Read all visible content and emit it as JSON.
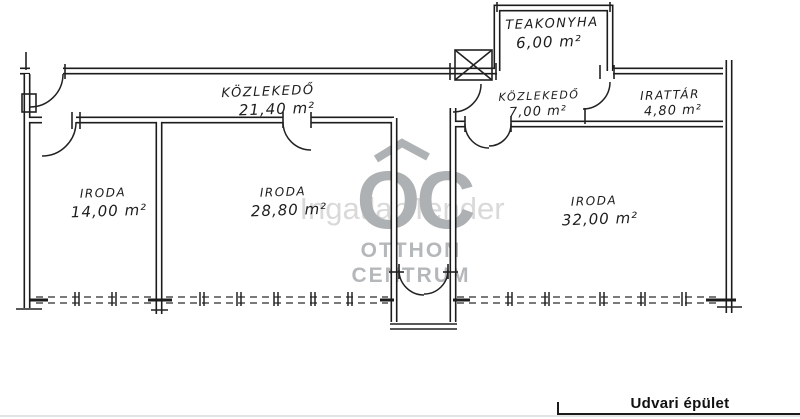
{
  "plan": {
    "caption": "Udvari épület",
    "rooms": [
      {
        "id": "teakonyha",
        "label": "TEAKONYHA",
        "area": "6,00 m²"
      },
      {
        "id": "kozlekedo-main",
        "label": "KÖZLEKEDŐ",
        "area": "21,40 m²"
      },
      {
        "id": "kozlekedo-small",
        "label": "KÖZLEKEDŐ",
        "area": "7,00 m²"
      },
      {
        "id": "irattar",
        "label": "IRATTÁR",
        "area": "4,80 m²"
      },
      {
        "id": "iroda-1",
        "label": "IRODA",
        "area": "14,00 m²"
      },
      {
        "id": "iroda-2",
        "label": "IRODA",
        "area": "28,80 m²"
      },
      {
        "id": "iroda-3",
        "label": "IRODA",
        "area": "32,00 m²"
      }
    ]
  },
  "watermark": {
    "logo": "OC",
    "brand_line1": "OTTHON",
    "brand_line2": "CENTRUM",
    "overlay": "IngatlanTender"
  },
  "colors": {
    "ink": "#1c1c1c",
    "watermark_gray": "#a9adaf",
    "watermark_light": "#d8d8d8",
    "paper": "#ffffff"
  }
}
